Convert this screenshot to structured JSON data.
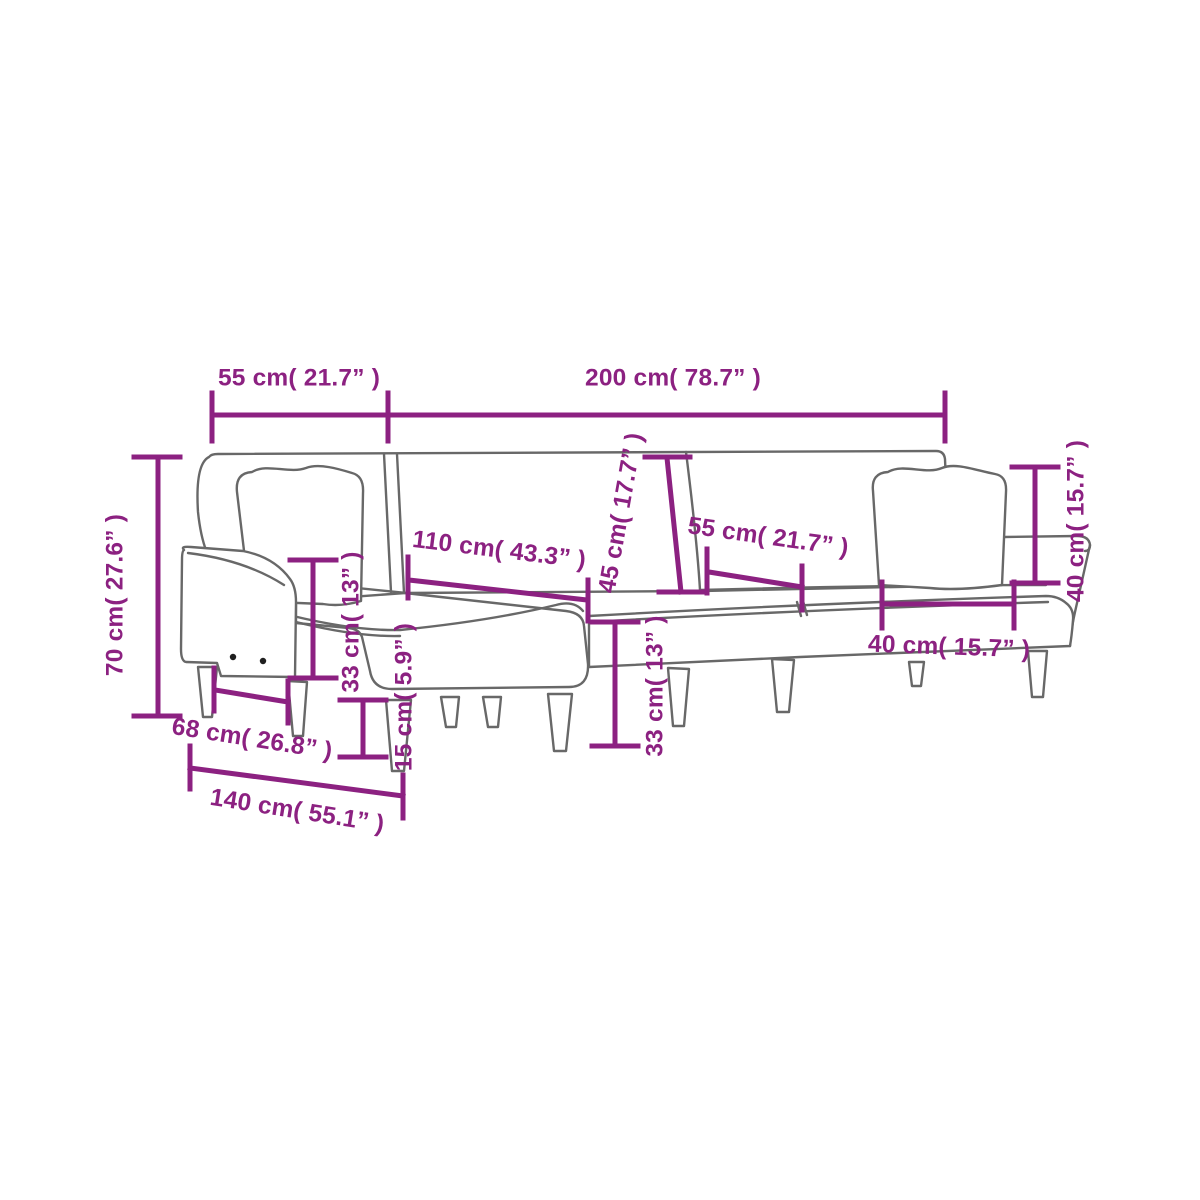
{
  "diagram": {
    "type": "product-dimension-diagram",
    "subject": "L-shaped sofa bed line drawing with dimension callouts",
    "colors": {
      "dimension": "#8C2181",
      "outline": "#686868",
      "background": "#ffffff"
    },
    "dimensions": {
      "top_left_width": "55 cm( 21.7” )",
      "top_right_width": "200 cm( 78.7” )",
      "overall_height": "70 cm( 27.6” )",
      "chaise_length": "110 cm( 43.3” )",
      "backrest_height": "45 cm( 17.7” )",
      "seat_depth_mid": "55 cm( 21.7” )",
      "back_cushion_height": "40 cm( 15.7” )",
      "seat_height_left": "33 cm( 13” )",
      "leg_height": "15 cm( 5.9” )",
      "seat_height_center": "33 cm( 13” )",
      "front_width": "68 cm( 26.8” )",
      "chaise_depth": "140 cm( 55.1” )",
      "seat_cushion_width": "40 cm( 15.7” )"
    }
  }
}
